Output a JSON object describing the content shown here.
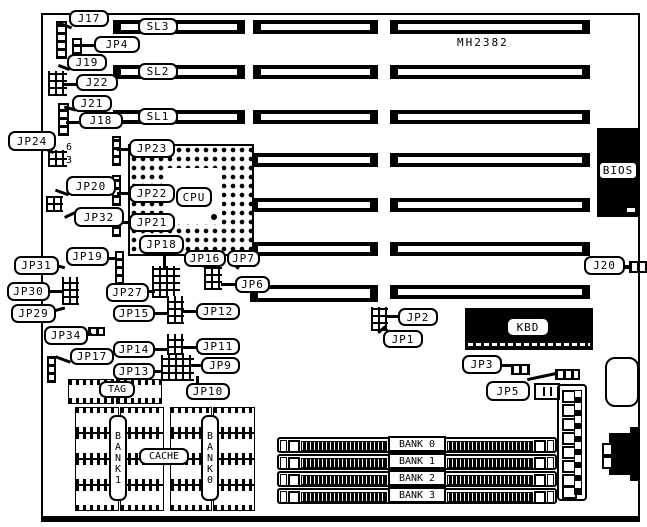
{
  "board": {
    "model": "MH2382"
  },
  "slots": {
    "sl1": "SL1",
    "sl2": "SL2",
    "sl3": "SL3"
  },
  "chips": {
    "cpu": "CPU",
    "kbd": "KBD",
    "bios": "BIOS",
    "tag": "TAG",
    "cache": "CACHE",
    "bank0_vertical": "BANK0",
    "bank1_vertical": "BANK1"
  },
  "jumpers": {
    "j17": "J17",
    "jp4": "JP4",
    "j19": "J19",
    "j22": "J22",
    "j21": "J21",
    "j18": "J18",
    "jp24": "JP24",
    "jp23": "JP23",
    "jp20": "JP20",
    "jp22": "JP22",
    "jp21": "JP21",
    "jp32": "JP32",
    "jp18": "JP18",
    "jp19": "JP19",
    "jp31": "JP31",
    "jp30": "JP30",
    "jp29": "JP29",
    "jp34": "JP34",
    "jp27": "JP27",
    "jp16": "JP16",
    "jp7": "JP7",
    "jp6": "JP6",
    "jp15": "JP15",
    "jp12": "JP12",
    "jp17": "JP17",
    "jp14": "JP14",
    "jp11": "JP11",
    "jp13": "JP13",
    "jp9": "JP9",
    "jp10": "JP10",
    "j20": "J20",
    "jp2": "JP2",
    "jp1": "JP1",
    "jp3": "JP3",
    "jp5": "JP5"
  },
  "pin_numbers": {
    "top": "6",
    "bottom": "3"
  },
  "simm_banks": [
    "BANK 0",
    "BANK 1",
    "BANK 2",
    "BANK 3"
  ]
}
